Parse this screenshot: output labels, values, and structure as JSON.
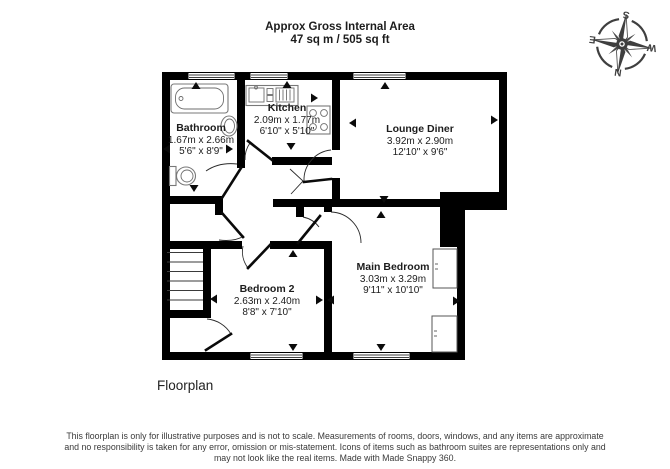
{
  "header": {
    "title_line1": "Approx Gross Internal Area",
    "title_line2": "47 sq m / 505 sq ft"
  },
  "compass": {
    "north": "N",
    "south": "S",
    "east": "E",
    "west": "W"
  },
  "rooms": [
    {
      "name": "Bathroom",
      "metric": "1.67m x 2.66m",
      "imperial": "5'6\" x 8'9\""
    },
    {
      "name": "Kitchen",
      "metric": "2.09m x 1.77m",
      "imperial": "6'10\" x 5'10\""
    },
    {
      "name": "Lounge Diner",
      "metric": "3.92m x 2.90m",
      "imperial": "12'10\" x 9'6\""
    },
    {
      "name": "Bedroom 2",
      "metric": "2.63m x 2.40m",
      "imperial": "8'8\" x 7'10\""
    },
    {
      "name": "Main Bedroom",
      "metric": "3.03m x 3.29m",
      "imperial": "9'11\" x 10'10\""
    }
  ],
  "footer": {
    "floorplan_label": "Floorplan",
    "disclaimer": "This floorplan is only for illustrative purposes and is not to scale. Measurements of rooms, doors, windows, and any items are approximate\nand no responsibility is taken for any error, omission or mis-statement. Icons of items such as bathroom suites are representations only and\nmay not look like the real items. Made with Made Snappy 360."
  },
  "colors": {
    "wall": "#000000",
    "text": "#1c1c1c",
    "compass": "#3f3f3f",
    "fixture": "#787878"
  }
}
